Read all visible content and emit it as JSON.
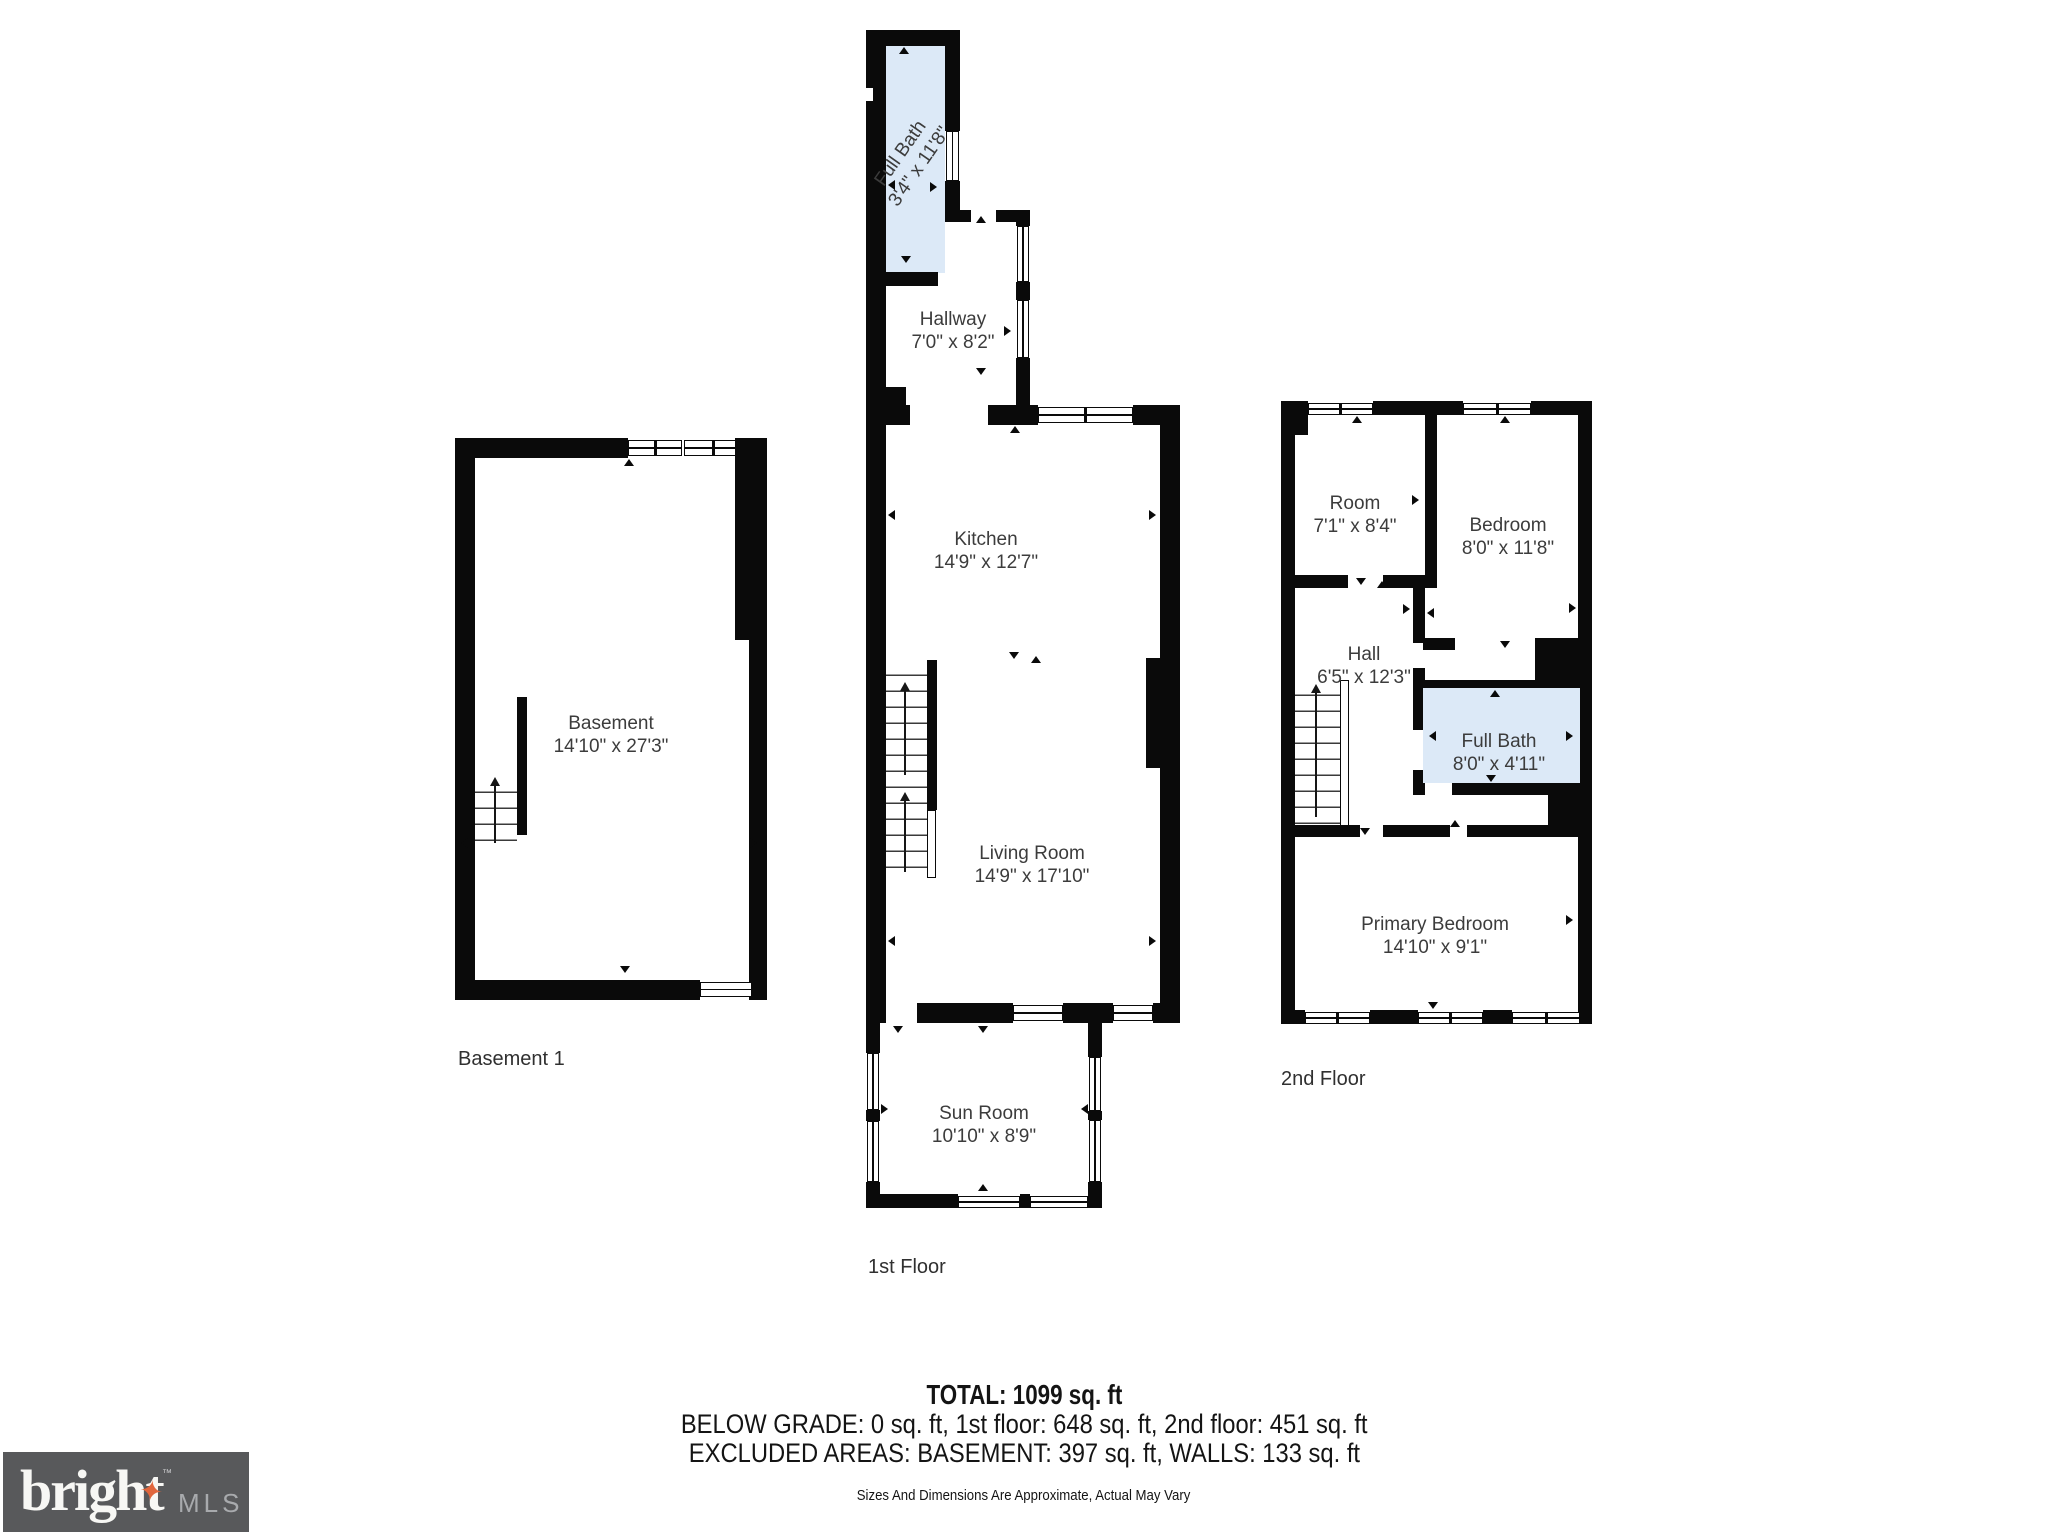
{
  "floors": {
    "basement": {
      "label": "Basement 1",
      "basement_room": {
        "name": "Basement",
        "dims": "14'10\" x 27'3\""
      }
    },
    "first": {
      "label": "1st Floor",
      "full_bath": {
        "name": "Full Bath",
        "dims": "3'4\" x 11'8\""
      },
      "hallway": {
        "name": "Hallway",
        "dims": "7'0\" x 8'2\""
      },
      "kitchen": {
        "name": "Kitchen",
        "dims": "14'9\" x 12'7\""
      },
      "living_room": {
        "name": "Living Room",
        "dims": "14'9\" x 17'10\""
      },
      "sun_room": {
        "name": "Sun Room",
        "dims": "10'10\" x 8'9\""
      }
    },
    "second": {
      "label": "2nd Floor",
      "room": {
        "name": "Room",
        "dims": "7'1\" x 8'4\""
      },
      "bedroom": {
        "name": "Bedroom",
        "dims": "8'0\" x 11'8\""
      },
      "hall": {
        "name": "Hall",
        "dims": "6'5\" x 12'3\""
      },
      "full_bath": {
        "name": "Full Bath",
        "dims": "8'0\" x 4'11\""
      },
      "primary_bedroom": {
        "name": "Primary Bedroom",
        "dims": "14'10\" x 9'1\""
      }
    }
  },
  "summary": {
    "total": "TOTAL: 1099 sq. ft",
    "line2": "BELOW GRADE: 0 sq. ft, 1st floor: 648 sq. ft, 2nd floor: 451 sq. ft",
    "line3": "EXCLUDED AREAS: BASEMENT: 397 sq. ft, WALLS: 133 sq. ft",
    "disclaimer": "Sizes And Dimensions Are Approximate, Actual May Vary"
  },
  "logo": {
    "brand": "bright",
    "suffix": "MLS",
    "tm": "™",
    "star": "✦"
  },
  "colors": {
    "wall": "#0a0a0a",
    "bath_fill": "#dce9f7",
    "text": "#3c3c3c",
    "logo_bg": "#58595b",
    "logo_star": "#e0663d"
  }
}
